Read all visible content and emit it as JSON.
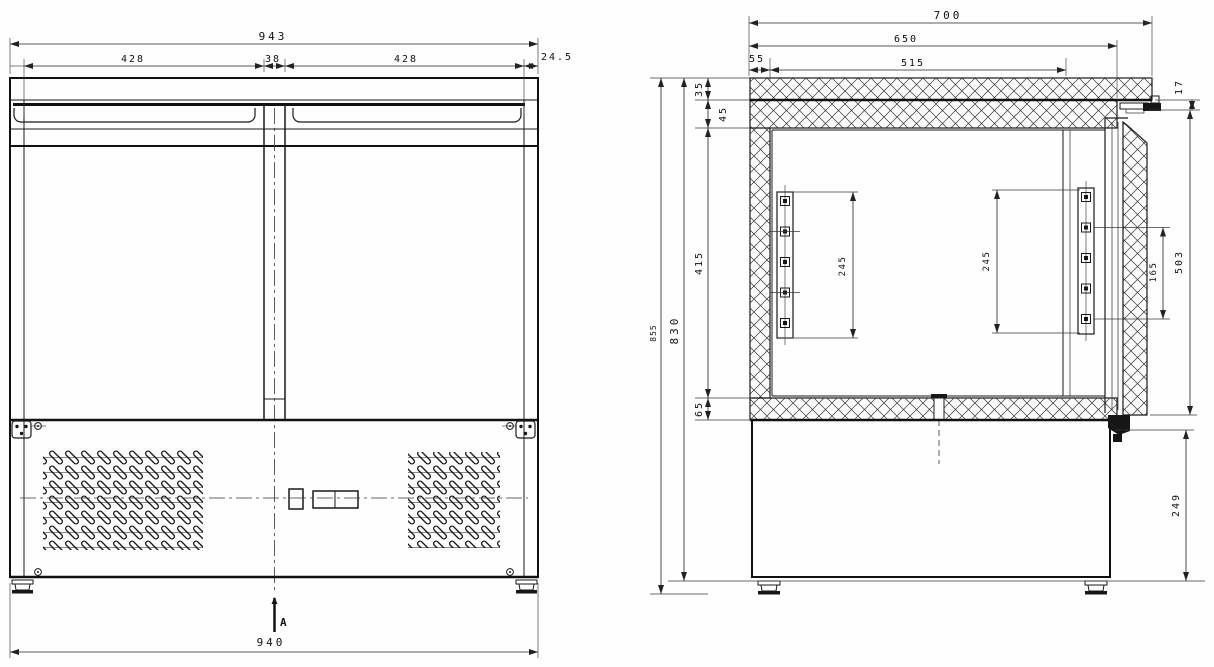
{
  "drawing": {
    "type": "technical-drawing",
    "subject": "two-door refrigerated counter, front view and side section view",
    "colors": {
      "line": "#1a1a1a",
      "background": "#fefefe"
    },
    "front": {
      "dims": {
        "overall_width": "943",
        "door_left_width": "428",
        "mullion_width": "38",
        "door_right_width": "428",
        "side_margin": "24.5",
        "base_width": "940",
        "section_label": "A"
      }
    },
    "side": {
      "dims": {
        "depth_overall": "700",
        "depth_body": "650",
        "back_offset": "55",
        "top_interior_depth": "515",
        "door_top_gap": "17",
        "worktop_layer_top": "35",
        "worktop_layer_bottom": "45",
        "interior_height": "415",
        "bottom_insulation": "65",
        "body_height": "830",
        "overall_height": "855",
        "rack_left_span": "245",
        "rack_right_span": "245",
        "rack_hole_span": "165",
        "door_height": "503",
        "base_height": "249"
      }
    }
  }
}
